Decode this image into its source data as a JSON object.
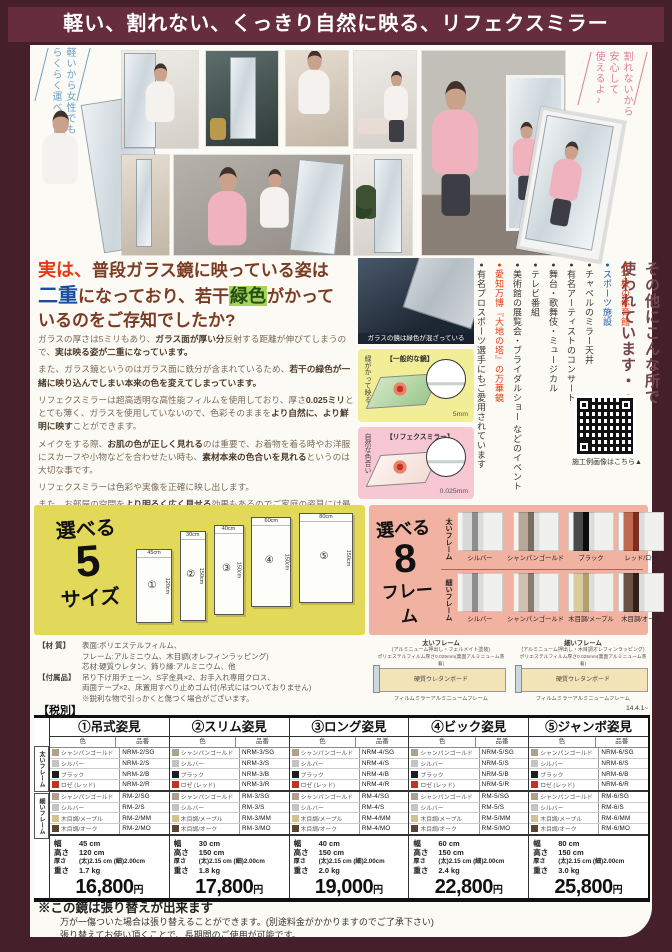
{
  "banner": {
    "title": "軽い、割れない、くっきり自然に映る、リフェクスミラー"
  },
  "photos": {
    "note_left": [
      "軽いから女性でも",
      "らくらく運べるよ♪"
    ],
    "note_right": [
      "割れないから",
      "安心して",
      "使えるよ♪"
    ]
  },
  "intro": {
    "headline_lines": [
      [
        {
          "t": "実は、",
          "c": "red"
        },
        {
          "t": "普段ガラス鏡に映っている姿は",
          "c": "m"
        }
      ],
      [
        {
          "t": "二重",
          "c": "blue"
        },
        {
          "t": "になっており、若干",
          "c": "m"
        },
        {
          "t": "緑色",
          "c": "green"
        },
        {
          "t": "がかって",
          "c": "m"
        }
      ],
      [
        {
          "t": "いるのをご存知でしたか?",
          "c": "m"
        }
      ]
    ],
    "paragraphs": [
      [
        {
          "t": "ガラスの厚さは5ミリもあり、"
        },
        {
          "t": "ガラス面が厚い分",
          "b": 1
        },
        {
          "t": "反射する距離が伸びてしまうので、"
        },
        {
          "t": "実は映る姿が二重になっています。",
          "b": 1
        }
      ],
      [
        {
          "t": "また、ガラス鏡というのはガラス面に鉄分が含まれているため、"
        },
        {
          "t": "若干の緑色が一緒に映り込んでしまい本来の色を変えてしまっています。",
          "b": 1
        }
      ],
      [
        {
          "t": "リフェクスミラーは超高透明な高性能フィルムを使用しており、厚さ"
        },
        {
          "t": "0.025ミリ",
          "b": 1
        },
        {
          "t": "ととても薄く、ガラスを使用していないので、色彩そのままを"
        },
        {
          "t": "より自然に、より鮮明に映す",
          "b": 1
        },
        {
          "t": "ことができます。"
        }
      ],
      [
        {
          "t": "メイクをする際、"
        },
        {
          "t": "お肌の色が正しく見れる",
          "b": 1
        },
        {
          "t": "のは重要で、お着物を着る時やお洋服にスカーフや小物などを合わせたい時も、"
        },
        {
          "t": "素材本来の色合いを見れる",
          "b": 1
        },
        {
          "t": "というのは大切な事です。"
        }
      ],
      [
        {
          "t": "リフェクスミラーは色彩や実像を正確に映し出します。"
        }
      ],
      [
        {
          "t": "また、お部屋の空間を"
        },
        {
          "t": "より明るく広く見せる",
          "b": 1
        },
        {
          "t": "効果もあるのでご家庭の姿見には最適です。"
        }
      ]
    ]
  },
  "diagrams": {
    "photo_caption": "ガラスの鏡は緑色が混ざっている",
    "normal": {
      "label": "【一般的な鏡】",
      "side": "緑がかって映る",
      "thickness": "5mm"
    },
    "refex": {
      "label": "【リフェクスミラー】",
      "side": "自然な色合い",
      "thickness": "0.025mm"
    }
  },
  "usage": {
    "title1": "その他にこんな所で",
    "title2": "使われています・・・",
    "items": [
      {
        "label": "学校の体育館",
        "color": "#e8380d"
      },
      {
        "label": "スポーツ施設",
        "color": "#1c5bb0"
      },
      {
        "label": "チャペルのミラー天井",
        "color": "#3a3a3a"
      },
      {
        "label": "有名アーティストのコンサート",
        "color": "#3a3a3a"
      },
      {
        "label": "舞台・歌舞伎・ミュージカル",
        "color": "#3a3a3a"
      },
      {
        "label": "テレビ番組",
        "color": "#3a3a3a"
      },
      {
        "label": "美術館の展覧会・ブライダルショー などのイベント",
        "color": "#3a3a3a"
      },
      {
        "label": "愛知万博『大地の塔』の万華鏡",
        "color": "#e8380d"
      },
      {
        "label": "有名プロスポーツ選手にもご愛用されています",
        "color": "#3a3a3a"
      }
    ],
    "qr_caption": "施工例画像はこちら▲"
  },
  "sizes": {
    "title_top": "選べる",
    "title_num": "5",
    "title_bottom": "サイズ",
    "mirrors": [
      {
        "no": "①",
        "w_label": "45cm",
        "h_label": "120cm",
        "w": 34,
        "h": 72,
        "dy": 0
      },
      {
        "no": "②",
        "w_label": "30cm",
        "h_label": "150cm",
        "w": 24,
        "h": 88,
        "dy": -2
      },
      {
        "no": "③",
        "w_label": "40cm",
        "h_label": "150cm",
        "w": 28,
        "h": 88,
        "dy": -8
      },
      {
        "no": "④",
        "w_label": "60cm",
        "h_label": "150cm",
        "w": 38,
        "h": 88,
        "dy": -16
      },
      {
        "no": "⑤",
        "w_label": "80cm",
        "h_label": "150cm",
        "w": 52,
        "h": 88,
        "dy": -20
      }
    ]
  },
  "frames": {
    "title_top": "選べる",
    "title_num": "8",
    "title_bottom": "フレーム",
    "thick_label": "太いフレーム",
    "thin_label": "細いフレーム",
    "thick": [
      {
        "label": "シルバー",
        "c1": "#d8d8d8",
        "c2": "#8e8e8e"
      },
      {
        "label": "シャンパンゴールド",
        "c1": "#b8a898",
        "c2": "#7a6e62"
      },
      {
        "label": "ブラック",
        "c1": "#4a4a4a",
        "c2": "#0c0c0c"
      },
      {
        "label": "レッド/ロゼ",
        "c1": "#c06a50",
        "c2": "#7a2f20"
      }
    ],
    "thin": [
      {
        "label": "シルバー",
        "c1": "#d8d8d8",
        "c2": "#8e8e8e"
      },
      {
        "label": "シャンパンゴールド",
        "c1": "#cfc0b0",
        "c2": "#8a7d70"
      },
      {
        "label": "木目調/メープル",
        "c1": "#d8cc9e",
        "c2": "#b0a070"
      },
      {
        "label": "木目調/オーク",
        "c1": "#6a5244",
        "c2": "#30201a"
      }
    ]
  },
  "materials": {
    "label1": "【材 質】",
    "lines1": [
      "表面:ポリエステルフィルム、",
      "フレーム:アルミニウム、木目調(オレフィンラッピング)",
      "芯材:硬質ウレタン、飾り縁:アルミニウム、他"
    ],
    "label2": "【付属品】",
    "lines2": [
      "吊り下げ用チェーン、S字金具×2、お手入れ専用クロス、",
      "両面テープ×2、床置用すべり止めゴム付(吊式にはついておりません)",
      "※鋭利な物で引っかくと傷つく場合がございます。"
    ],
    "tax_label": "【税別】",
    "xsec": {
      "thick_title": "太いフレーム",
      "thick_sub": "(アルミニューム押出し・フェルメイト塗装)",
      "thin_title": "細いフレーム",
      "thin_sub": "(アルミニューム押出し・木目調オレフィンラッピング)",
      "film_note": "ポリエステルフィルム厚さ0.025mm(裏面アルミニューム蒸着)",
      "board": "硬質ウレタンボード",
      "frame_note": "フィルムミラーアルミニュームフレーム",
      "version": "14.4.1~"
    }
  },
  "price_table": {
    "sub_color": "色",
    "sub_code": "品番",
    "group_thick": "太いフレーム",
    "group_thin": "細いフレーム",
    "colors_thick": [
      {
        "name": "シャンパンゴールド",
        "chip": "#b0a08e"
      },
      {
        "name": "シルバー",
        "chip": "#c4c4c4"
      },
      {
        "name": "ブラック",
        "chip": "#1e1e1e"
      },
      {
        "name": "ロゼ (レッド)",
        "chip": "#c03424"
      }
    ],
    "colors_thin": [
      {
        "name": "シャンパンゴールド",
        "chip": "#b0a08e"
      },
      {
        "name": "シルバー",
        "chip": "#c4c4c4"
      },
      {
        "name": "木目調/メープル",
        "chip": "#d2c28e"
      },
      {
        "name": "木目調/オーク",
        "chip": "#5a4434"
      }
    ],
    "spec_labels": {
      "width": "幅",
      "height": "高さ",
      "thickness": "厚さ",
      "weight": "重さ"
    },
    "yen": "円",
    "columns": [
      {
        "header": "①吊式姿見",
        "codes_thick": [
          "NRM-2/SG",
          "NRM-2/S",
          "NRM-2/B",
          "NRM-2/R"
        ],
        "codes_thin": [
          "RM-2/SG",
          "RM-2/S",
          "RM-2/MM",
          "RM-2/MO"
        ],
        "specs": {
          "width": "45 cm",
          "height": "120 cm",
          "thickness": "(太)2.15 cm (細)2.00cm",
          "weight": "1.7 kg"
        },
        "price": "16,800"
      },
      {
        "header": "②スリム姿見",
        "codes_thick": [
          "NRM-3/SG",
          "NRM-3/S",
          "NRM-3/B",
          "NRM-3/R"
        ],
        "codes_thin": [
          "RM-3/SG",
          "RM-3/S",
          "RM-3/MM",
          "RM-3/MO"
        ],
        "specs": {
          "width": "30 cm",
          "height": "150 cm",
          "thickness": "(太)2.15 cm (細)2.00cm",
          "weight": "1.8 kg"
        },
        "price": "17,800"
      },
      {
        "header": "③ロング姿見",
        "codes_thick": [
          "NRM-4/SG",
          "NRM-4/S",
          "NRM-4/B",
          "NRM-4/R"
        ],
        "codes_thin": [
          "RM-4/SG",
          "RM-4/S",
          "RM-4/MM",
          "RM-4/MO"
        ],
        "specs": {
          "width": "40 cm",
          "height": "150 cm",
          "thickness": "(太)2.15 cm (細)2.00cm",
          "weight": "2.0 kg"
        },
        "price": "19,000"
      },
      {
        "header": "④ビック姿見",
        "codes_thick": [
          "NRM-5/SG",
          "NRM-5/S",
          "NRM-5/B",
          "NRM-5/R"
        ],
        "codes_thin": [
          "RM-5/SG",
          "RM-5/S",
          "RM-5/MM",
          "RM-5/MO"
        ],
        "specs": {
          "width": "60 cm",
          "height": "150 cm",
          "thickness": "(太)2.15 cm (細)2.00cm",
          "weight": "2.4 kg"
        },
        "price": "22,800"
      },
      {
        "header": "⑤ジャンボ姿見",
        "codes_thick": [
          "NRM-6/SG",
          "NRM-6/S",
          "NRM-6/B",
          "NRM-6/R"
        ],
        "codes_thin": [
          "RM-6/SG",
          "RM-6/S",
          "RM-6/MM",
          "RM-6/MO"
        ],
        "specs": {
          "width": "80 cm",
          "height": "150 cm",
          "thickness": "(太)2.15 cm (細)2.00cm",
          "weight": "3.0 kg"
        },
        "price": "25,800"
      }
    ]
  },
  "footer": {
    "title": "※この鏡は張り替えが出来ます",
    "line1": "万が一傷ついた場合は張り替えることができます。(別途料金がかかりますのでご了承下さい)",
    "line2": "張り替えてお使い頂くことで、長期間のご使用が可能です。"
  }
}
